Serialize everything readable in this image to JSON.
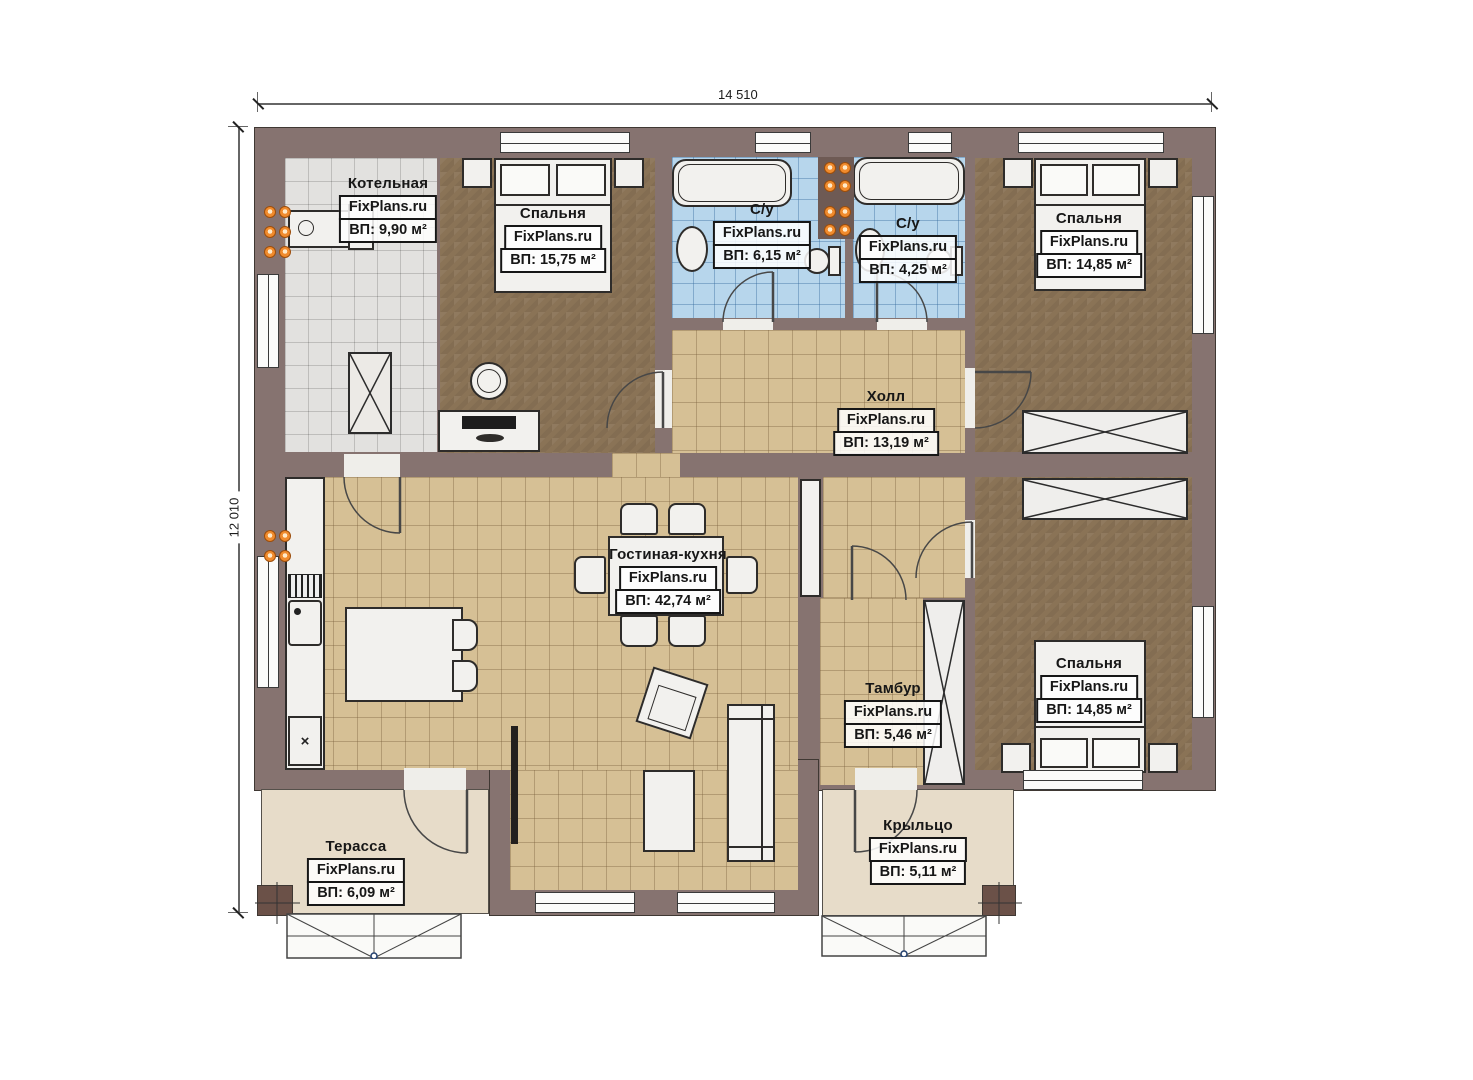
{
  "dimensions": {
    "width_label": "14 510",
    "height_label": "12 010"
  },
  "rooms": [
    {
      "id": "boiler",
      "name": "Котельная",
      "watermark": "FixPlans.ru",
      "area": "ВП: 9,90 м²"
    },
    {
      "id": "bedroom1",
      "name": "Спальня",
      "watermark": "FixPlans.ru",
      "area": "ВП: 15,75 м²"
    },
    {
      "id": "bath1",
      "name": "С/у",
      "watermark": "FixPlans.ru",
      "area": "ВП: 6,15 м²"
    },
    {
      "id": "bath2",
      "name": "С/у",
      "watermark": "FixPlans.ru",
      "area": "ВП: 4,25 м²"
    },
    {
      "id": "bedroom2",
      "name": "Спальня",
      "watermark": "FixPlans.ru",
      "area": "ВП: 14,85 м²"
    },
    {
      "id": "hall",
      "name": "Холл",
      "watermark": "FixPlans.ru",
      "area": "ВП: 13,19 м²"
    },
    {
      "id": "living",
      "name": "Гостиная-кухня",
      "watermark": "FixPlans.ru",
      "area": "ВП: 42,74 м²"
    },
    {
      "id": "tambour",
      "name": "Тамбур",
      "watermark": "FixPlans.ru",
      "area": "ВП: 5,46 м²"
    },
    {
      "id": "bedroom3",
      "name": "Спальня",
      "watermark": "FixPlans.ru",
      "area": "ВП: 14,85 м²"
    },
    {
      "id": "terrace",
      "name": "Терасса",
      "watermark": "FixPlans.ru",
      "area": "ВП: 6,09 м²"
    },
    {
      "id": "porch",
      "name": "Крыльцо",
      "watermark": "FixPlans.ru",
      "area": "ВП: 5,11 м²"
    }
  ],
  "symbols": {
    "appliance_mark": "×"
  },
  "colors": {
    "wall": "#867370",
    "post": "#6b5148",
    "floor_tan": "#d6c095",
    "floor_brown": "#8a7356",
    "floor_tile_blue": "#b7d6ec",
    "floor_tile_gray": "#e2e1df",
    "floor_outdoor": "#e7dcc9",
    "radiator": "#f08b2d"
  }
}
